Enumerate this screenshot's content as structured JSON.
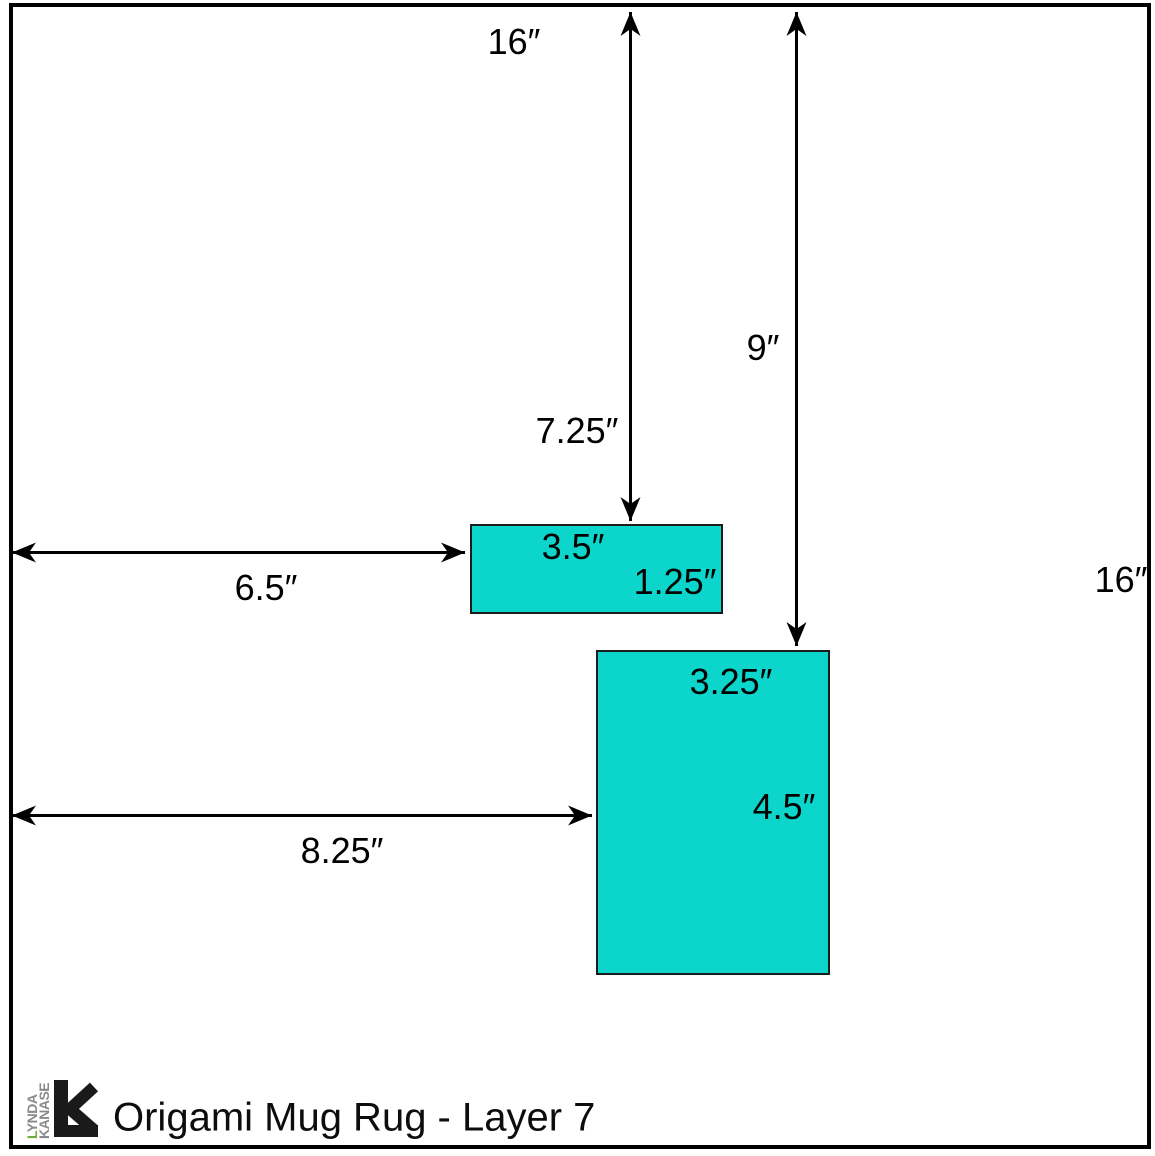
{
  "colors": {
    "background": "#ffffff",
    "frame": "#000000",
    "piece_fill": "#0cd6cc",
    "piece_border": "#1c1c1c",
    "logo_grey": "#8a8a8a",
    "logo_green": "#6fae3f"
  },
  "square": {
    "top_width_label": "16″",
    "right_height_label": "16″"
  },
  "arrows": {
    "top_to_piece1": {
      "label": "7.25″"
    },
    "top_to_piece2": {
      "label": "9″"
    },
    "left_to_piece1": {
      "label": "6.5″"
    },
    "left_to_piece2": {
      "label": "8.25″"
    }
  },
  "pieces": {
    "piece1": {
      "width_label": "3.5″",
      "height_label": "1.25″"
    },
    "piece2": {
      "width_label": "3.25″",
      "height_label": "4.5″"
    }
  },
  "footer": {
    "title": "Origami Mug Rug - Layer 7",
    "logo": {
      "word1_initial": "L",
      "word1_rest": "YNDA",
      "word2": "KANASE"
    }
  }
}
